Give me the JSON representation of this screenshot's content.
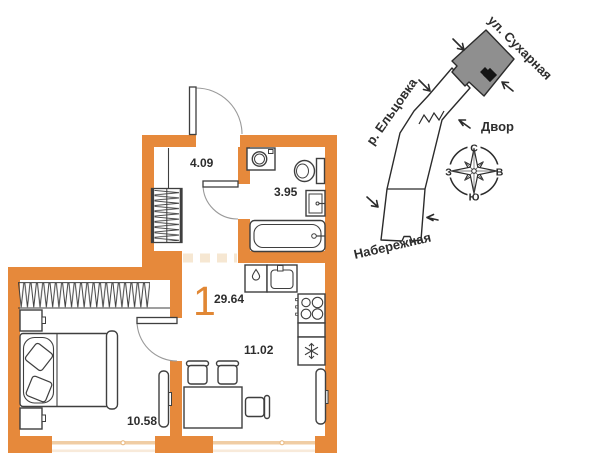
{
  "floor_plan": {
    "rooms_count": "1",
    "total_area_sqm": "29.64",
    "rooms": {
      "hallway": {
        "area_sqm": "4.09"
      },
      "bathroom": {
        "area_sqm": "3.95"
      },
      "kitchen_living": {
        "area_sqm": "11.02"
      },
      "bedroom": {
        "area_sqm": "10.58"
      }
    },
    "colors": {
      "wall_orange": "#E6893B",
      "accent_orange": "#E18734",
      "furniture_line": "#3F3F3F",
      "opening_dash": "#F6E7D2",
      "window_line": "#F0CDA4"
    }
  },
  "site_plan": {
    "labels": {
      "street_top": "ул. Сухарная",
      "river_left": "р. Ельцовка",
      "courtyard": "Двор",
      "street_bottom": "Набережная"
    },
    "building_fill": "#8F8F8F",
    "compass": {
      "north": "С",
      "south": "Ю",
      "west": "З",
      "east": "В"
    }
  }
}
